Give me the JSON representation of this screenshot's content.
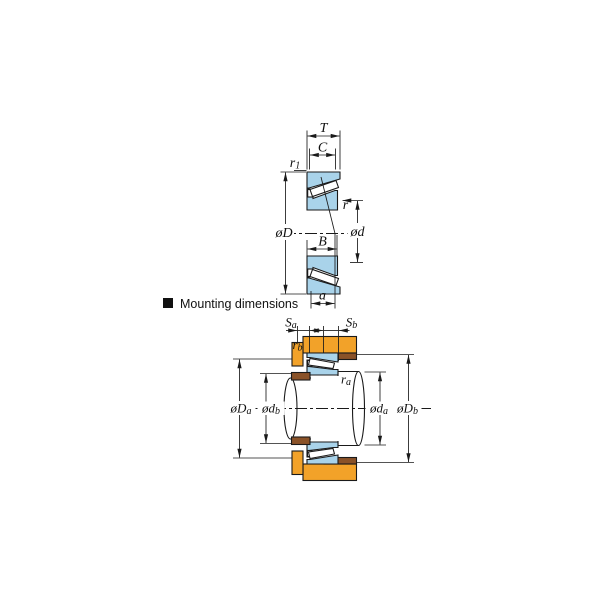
{
  "colors": {
    "bearing": "#a9d3ea",
    "roller": "#ffffff",
    "housing": "#f2a229",
    "spacer": "#8a5228",
    "line": "#1a1a1a"
  },
  "section_header": {
    "bullet": "■",
    "label": "Mounting dimensions"
  },
  "bearing_diagram": {
    "labels": {
      "T": "T",
      "C": "C",
      "r1": {
        "base": "r",
        "sub": "1"
      },
      "oD": "øD",
      "r": "r",
      "od": "ød",
      "B": "B",
      "a": "a"
    }
  },
  "mounting_diagram": {
    "labels": {
      "Sa": {
        "base": "S",
        "sub": "a"
      },
      "Sb": {
        "base": "S",
        "sub": "b"
      },
      "rb": {
        "base": "r",
        "sub": "b"
      },
      "ra": {
        "base": "r",
        "sub": "a"
      },
      "oDa": {
        "base": "øD",
        "sub": "a"
      },
      "odb": {
        "base": "ød",
        "sub": "b"
      },
      "oda": {
        "base": "ød",
        "sub": "a"
      },
      "oDb": {
        "base": "øD",
        "sub": "b"
      }
    }
  }
}
